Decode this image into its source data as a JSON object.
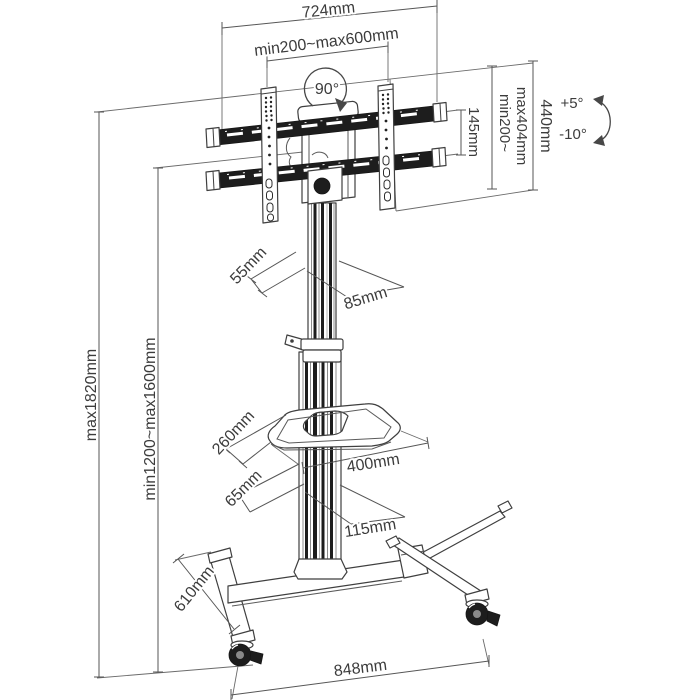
{
  "diagram": {
    "type": "technical-dimension-drawing",
    "subject": "mobile-tv-cart-with-shelf-and-casters",
    "colors": {
      "line": "#3f3f3f",
      "dark_fill": "#1d1d1d",
      "text": "#3c3c3c",
      "background": "#ffffff"
    },
    "labels": {
      "top_width": "724mm",
      "vesa_width_range": "min200~max600mm",
      "swivel_angle": "90°",
      "rail_spacing": "145mm",
      "vesa_height_range_line1": "min200~",
      "vesa_height_range_line2": "max404mm",
      "bracket_height": "440mm",
      "tilt_up": "+5°",
      "tilt_down": "-10°",
      "column_depth": "55mm",
      "column_width": "85mm",
      "max_height": "max1820mm",
      "screen_height_range": "min1200~max1600mm",
      "shelf_depth": "260mm",
      "shelf_width": "400mm",
      "base_column_depth": "65mm",
      "base_column_width": "115mm",
      "base_leg_depth": "610mm",
      "base_width": "848mm"
    }
  }
}
